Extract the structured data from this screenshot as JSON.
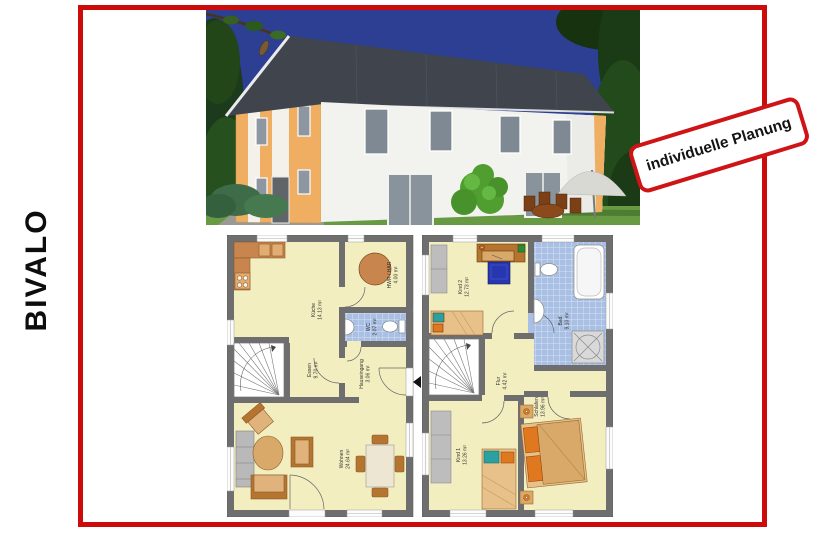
{
  "page": {
    "product_name": "BIVALO"
  },
  "stamp": {
    "label": "individuelle Planung"
  },
  "colors": {
    "frame_red": "#cc0b0b",
    "stamp_red": "#cf1417",
    "plan_floor_yellow": "#f3eec0",
    "plan_wall_grey": "#6e6e6e",
    "bath_tile_blue": "#a9c0e4",
    "facade_accent_orange": "#efae62",
    "roof_grey": "#40444c",
    "sky_blue": "#2c3f93"
  },
  "plans": {
    "ground_floor": {
      "rooms": [
        {
          "name": "Küche",
          "area": "14.13 m²"
        },
        {
          "name": "HWR / HAR",
          "area": "4.00 m²"
        },
        {
          "name": "WC",
          "area": "2.07 m²"
        },
        {
          "name": "Hauseingang",
          "area": "3.06 m²"
        },
        {
          "name": "Essen",
          "area": "9.70 m²"
        },
        {
          "name": "Wohnen",
          "area": "24.64 m²"
        }
      ]
    },
    "upper_floor": {
      "rooms": [
        {
          "name": "Kind 2",
          "area": "12.73 m²"
        },
        {
          "name": "Bad",
          "area": "9.10 m²"
        },
        {
          "name": "Flur",
          "area": "4.42 m²"
        },
        {
          "name": "Kind 1",
          "area": "13.26 m²"
        },
        {
          "name": "Schlafen",
          "area": "13.96 m²"
        }
      ]
    }
  }
}
